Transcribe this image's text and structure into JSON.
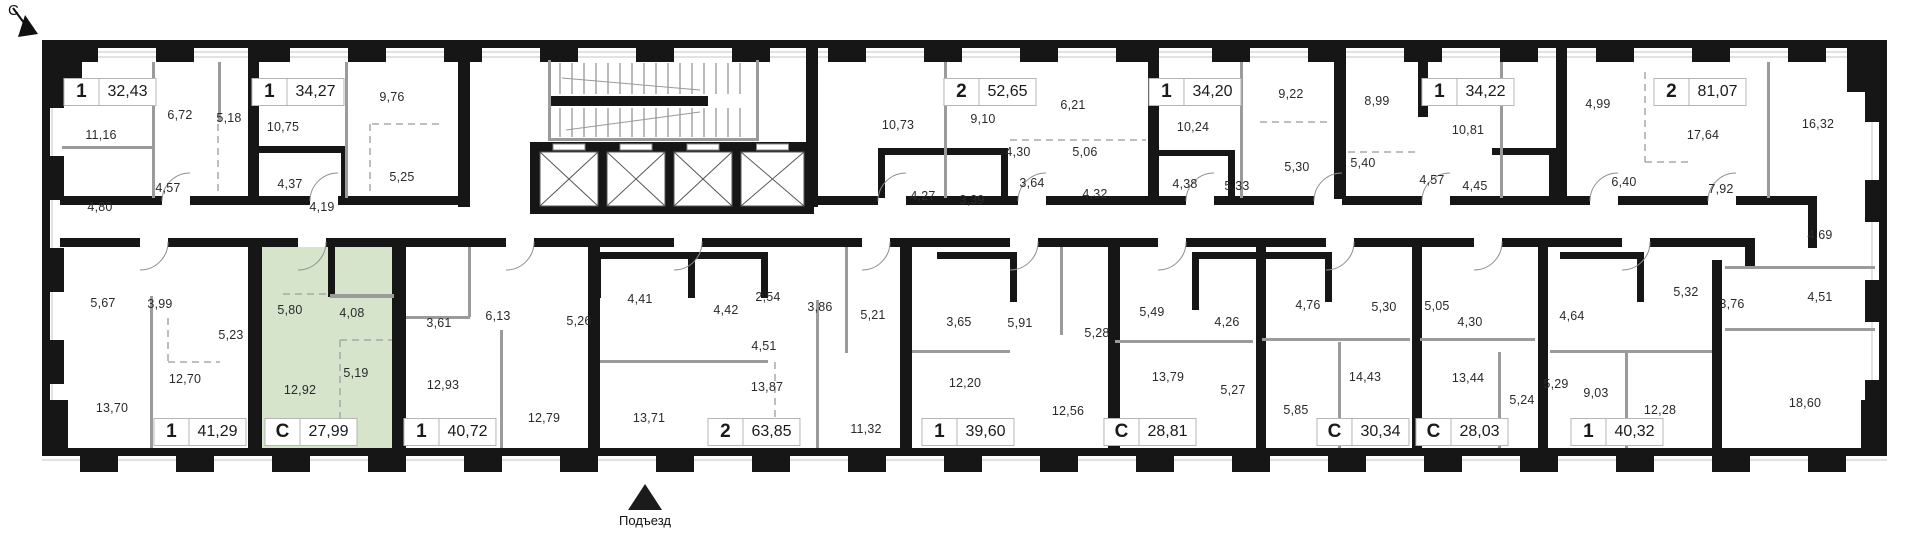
{
  "north": {
    "label": "С"
  },
  "entrance": {
    "label": "Подъезд"
  },
  "colors": {
    "highlight": "#d5e4cb",
    "wall": "#161616",
    "partition": "#9b9b9b",
    "badge_border": "#b5b5b5"
  },
  "apartments": [
    {
      "type": "1",
      "area": "32,43",
      "x": 110,
      "y": 92,
      "highlighted": false
    },
    {
      "type": "1",
      "area": "34,27",
      "x": 298,
      "y": 92,
      "highlighted": false
    },
    {
      "type": "2",
      "area": "52,65",
      "x": 990,
      "y": 92,
      "highlighted": false
    },
    {
      "type": "1",
      "area": "34,20",
      "x": 1195,
      "y": 92,
      "highlighted": false
    },
    {
      "type": "1",
      "area": "34,22",
      "x": 1468,
      "y": 92,
      "highlighted": false
    },
    {
      "type": "2",
      "area": "81,07",
      "x": 1700,
      "y": 92,
      "highlighted": false
    },
    {
      "type": "1",
      "area": "41,29",
      "x": 200,
      "y": 432,
      "highlighted": false
    },
    {
      "type": "С",
      "area": "27,99",
      "x": 311,
      "y": 432,
      "highlighted": true
    },
    {
      "type": "1",
      "area": "40,72",
      "x": 450,
      "y": 432,
      "highlighted": false
    },
    {
      "type": "2",
      "area": "63,85",
      "x": 754,
      "y": 432,
      "highlighted": false
    },
    {
      "type": "1",
      "area": "39,60",
      "x": 968,
      "y": 432,
      "highlighted": false
    },
    {
      "type": "С",
      "area": "28,81",
      "x": 1150,
      "y": 432,
      "highlighted": false
    },
    {
      "type": "С",
      "area": "30,34",
      "x": 1363,
      "y": 432,
      "highlighted": false
    },
    {
      "type": "С",
      "area": "28,03",
      "x": 1462,
      "y": 432,
      "highlighted": false
    },
    {
      "type": "1",
      "area": "40,32",
      "x": 1617,
      "y": 432,
      "highlighted": false
    }
  ],
  "rooms": [
    {
      "t": "11,16",
      "x": 101,
      "y": 135
    },
    {
      "t": "6,72",
      "x": 180,
      "y": 115
    },
    {
      "t": "5,18",
      "x": 229,
      "y": 118
    },
    {
      "t": "4,80",
      "x": 100,
      "y": 207
    },
    {
      "t": "4,57",
      "x": 168,
      "y": 188
    },
    {
      "t": "10,75",
      "x": 283,
      "y": 127
    },
    {
      "t": "4,37",
      "x": 290,
      "y": 184
    },
    {
      "t": "4,19",
      "x": 322,
      "y": 207
    },
    {
      "t": "9,76",
      "x": 392,
      "y": 97
    },
    {
      "t": "5,25",
      "x": 402,
      "y": 177
    },
    {
      "t": "10,73",
      "x": 898,
      "y": 125
    },
    {
      "t": "9,10",
      "x": 983,
      "y": 119
    },
    {
      "t": "4,27",
      "x": 923,
      "y": 196
    },
    {
      "t": "3,39",
      "x": 972,
      "y": 200
    },
    {
      "t": "4,30",
      "x": 1018,
      "y": 152
    },
    {
      "t": "3,64",
      "x": 1032,
      "y": 183
    },
    {
      "t": "6,21",
      "x": 1073,
      "y": 105
    },
    {
      "t": "5,06",
      "x": 1085,
      "y": 152
    },
    {
      "t": "4,32",
      "x": 1095,
      "y": 194
    },
    {
      "t": "10,24",
      "x": 1193,
      "y": 127
    },
    {
      "t": "4,38",
      "x": 1185,
      "y": 184
    },
    {
      "t": "5,33",
      "x": 1237,
      "y": 186
    },
    {
      "t": "9,22",
      "x": 1291,
      "y": 94
    },
    {
      "t": "5,30",
      "x": 1297,
      "y": 167
    },
    {
      "t": "8,99",
      "x": 1377,
      "y": 101
    },
    {
      "t": "5,40",
      "x": 1363,
      "y": 163
    },
    {
      "t": "4,57",
      "x": 1432,
      "y": 180
    },
    {
      "t": "10,81",
      "x": 1468,
      "y": 130
    },
    {
      "t": "4,45",
      "x": 1475,
      "y": 186
    },
    {
      "t": "4,99",
      "x": 1598,
      "y": 104
    },
    {
      "t": "17,64",
      "x": 1703,
      "y": 135
    },
    {
      "t": "6,40",
      "x": 1624,
      "y": 182
    },
    {
      "t": "7,92",
      "x": 1721,
      "y": 189
    },
    {
      "t": "16,32",
      "x": 1818,
      "y": 124
    },
    {
      "t": "4,69",
      "x": 1820,
      "y": 235
    },
    {
      "t": "4,51",
      "x": 1820,
      "y": 297
    },
    {
      "t": "5,32",
      "x": 1686,
      "y": 292
    },
    {
      "t": "3,76",
      "x": 1732,
      "y": 304
    },
    {
      "t": "5,67",
      "x": 103,
      "y": 303
    },
    {
      "t": "3,99",
      "x": 160,
      "y": 304
    },
    {
      "t": "5,23",
      "x": 231,
      "y": 335
    },
    {
      "t": "12,70",
      "x": 185,
      "y": 379
    },
    {
      "t": "13,70",
      "x": 112,
      "y": 408
    },
    {
      "t": "5,80",
      "x": 290,
      "y": 310
    },
    {
      "t": "4,08",
      "x": 352,
      "y": 313
    },
    {
      "t": "5,19",
      "x": 356,
      "y": 373
    },
    {
      "t": "12,92",
      "x": 300,
      "y": 390
    },
    {
      "t": "3,61",
      "x": 439,
      "y": 323
    },
    {
      "t": "6,13",
      "x": 498,
      "y": 316
    },
    {
      "t": "5,26",
      "x": 579,
      "y": 321
    },
    {
      "t": "12,93",
      "x": 443,
      "y": 385
    },
    {
      "t": "12,79",
      "x": 544,
      "y": 418
    },
    {
      "t": "4,41",
      "x": 640,
      "y": 299
    },
    {
      "t": "4,42",
      "x": 726,
      "y": 310
    },
    {
      "t": "2,54",
      "x": 768,
      "y": 297
    },
    {
      "t": "3,86",
      "x": 820,
      "y": 307
    },
    {
      "t": "4,51",
      "x": 764,
      "y": 346
    },
    {
      "t": "13,87",
      "x": 767,
      "y": 387
    },
    {
      "t": "13,71",
      "x": 649,
      "y": 418
    },
    {
      "t": "11,32",
      "x": 866,
      "y": 429
    },
    {
      "t": "5,21",
      "x": 873,
      "y": 315
    },
    {
      "t": "3,65",
      "x": 959,
      "y": 322
    },
    {
      "t": "5,91",
      "x": 1020,
      "y": 323
    },
    {
      "t": "12,20",
      "x": 965,
      "y": 383
    },
    {
      "t": "12,56",
      "x": 1068,
      "y": 411
    },
    {
      "t": "5,28",
      "x": 1097,
      "y": 333
    },
    {
      "t": "5,49",
      "x": 1152,
      "y": 312
    },
    {
      "t": "4,26",
      "x": 1227,
      "y": 322
    },
    {
      "t": "13,79",
      "x": 1168,
      "y": 377
    },
    {
      "t": "5,27",
      "x": 1233,
      "y": 390
    },
    {
      "t": "4,76",
      "x": 1308,
      "y": 305
    },
    {
      "t": "5,85",
      "x": 1296,
      "y": 410
    },
    {
      "t": "14,43",
      "x": 1365,
      "y": 377
    },
    {
      "t": "5,30",
      "x": 1384,
      "y": 307
    },
    {
      "t": "5,05",
      "x": 1437,
      "y": 306
    },
    {
      "t": "4,30",
      "x": 1470,
      "y": 322
    },
    {
      "t": "13,44",
      "x": 1468,
      "y": 378
    },
    {
      "t": "5,24",
      "x": 1522,
      "y": 400
    },
    {
      "t": "4,64",
      "x": 1572,
      "y": 316
    },
    {
      "t": "5,29",
      "x": 1556,
      "y": 384
    },
    {
      "t": "9,03",
      "x": 1596,
      "y": 393
    },
    {
      "t": "12,28",
      "x": 1660,
      "y": 410
    },
    {
      "t": "18,60",
      "x": 1805,
      "y": 403
    }
  ]
}
